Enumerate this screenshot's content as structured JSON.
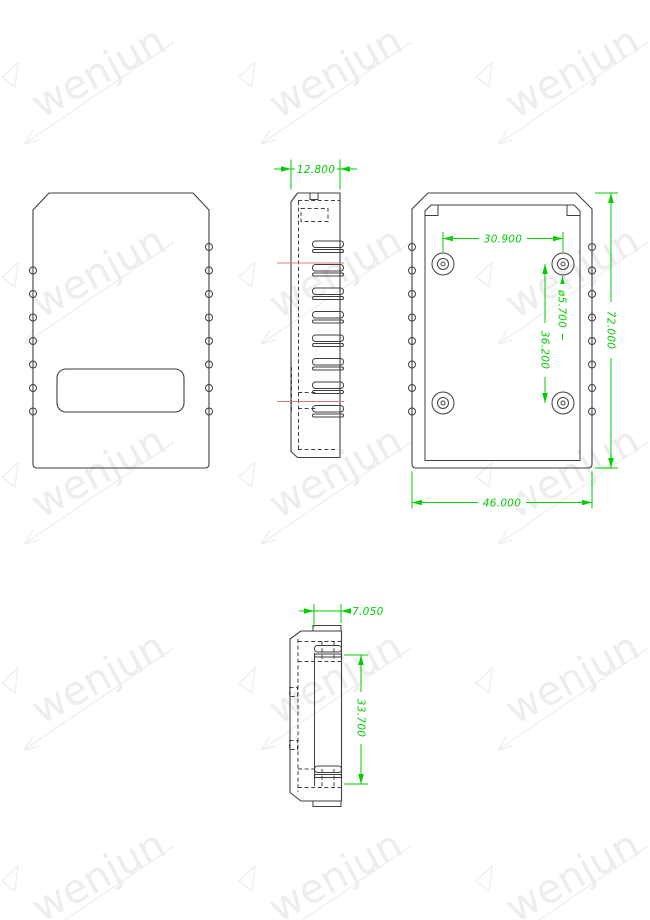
{
  "watermark": {
    "text": "wenjun"
  },
  "colors": {
    "line": "#3f3f3f",
    "dimension": "#00cc00",
    "section_line": "#e07a7a",
    "watermark": "#ededed"
  },
  "dimensions": {
    "side_width": "12.800",
    "hole_spacing_x": "30.900",
    "hole_diameter": "ø5.700",
    "hole_spacing_y": "36.200",
    "body_height": "72.000",
    "body_width": "46.000",
    "tab_offset": "7.050",
    "opening_height": "33.700"
  }
}
